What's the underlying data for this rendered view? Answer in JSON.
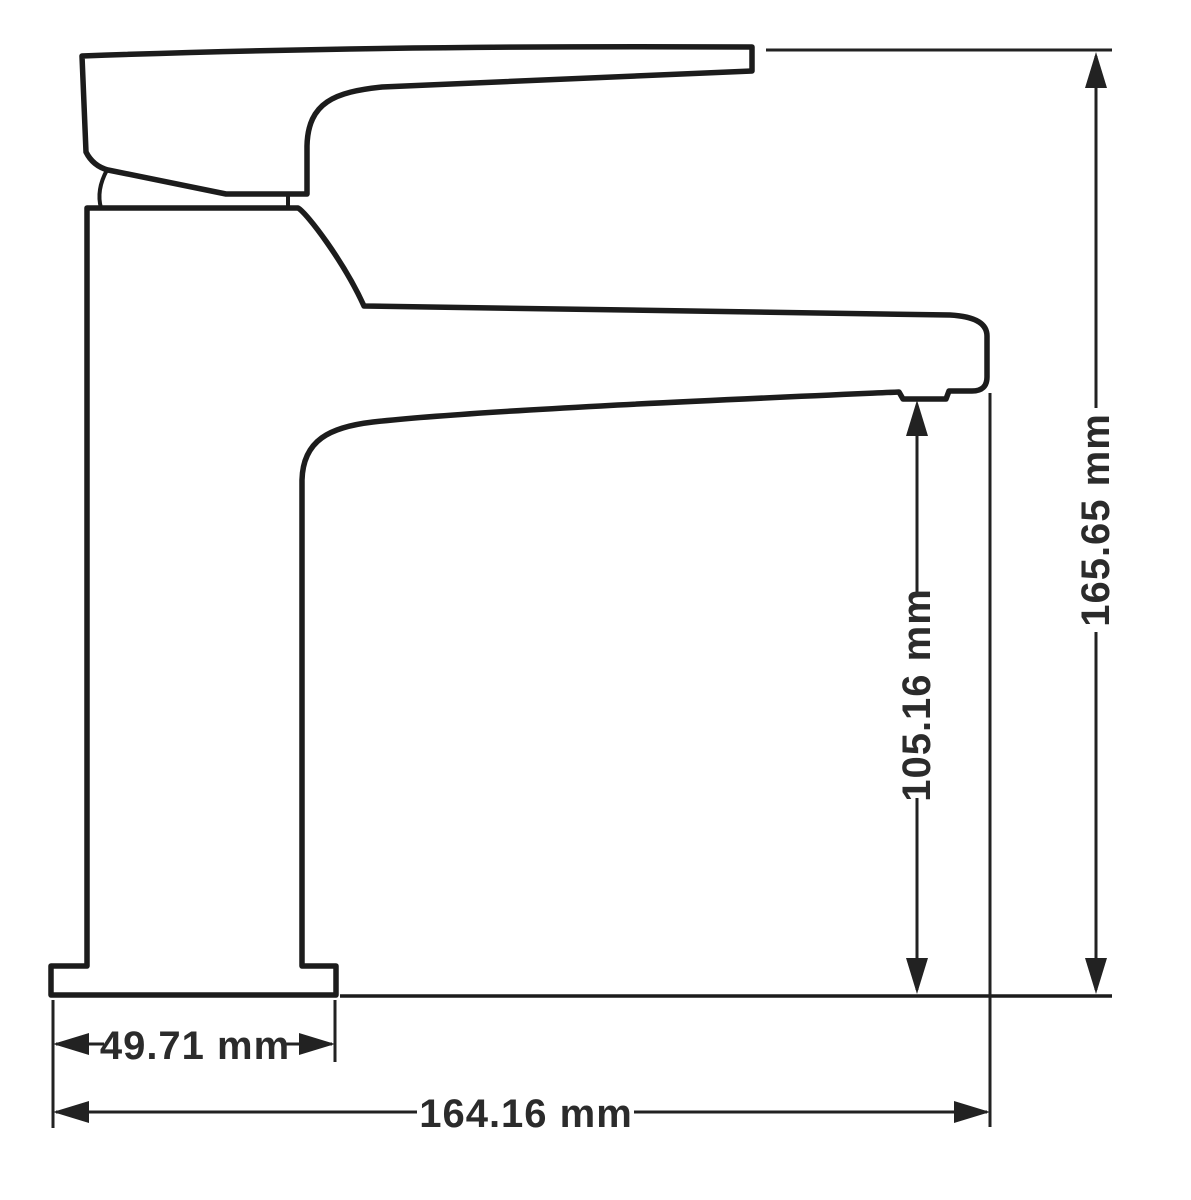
{
  "figure": {
    "kind": "technical-dimension-drawing",
    "view": "side-elevation-basin-mixer-tap"
  },
  "dimensions": {
    "overall_height": {
      "label": "165.65 mm",
      "value": 165.65,
      "unit": "mm",
      "orientation": "vertical"
    },
    "spout_outlet_height": {
      "label": "105.16 mm",
      "value": 105.16,
      "unit": "mm",
      "orientation": "vertical"
    },
    "base_width": {
      "label": "49.71 mm",
      "value": 49.71,
      "unit": "mm",
      "orientation": "horizontal"
    },
    "overall_depth": {
      "label": "164.16 mm",
      "value": 164.16,
      "unit": "mm",
      "orientation": "horizontal"
    }
  },
  "colors": {
    "outline": "#1c1c1c",
    "dimension_lines": "#222222",
    "text": "#2b2b2b",
    "background": "#ffffff"
  }
}
